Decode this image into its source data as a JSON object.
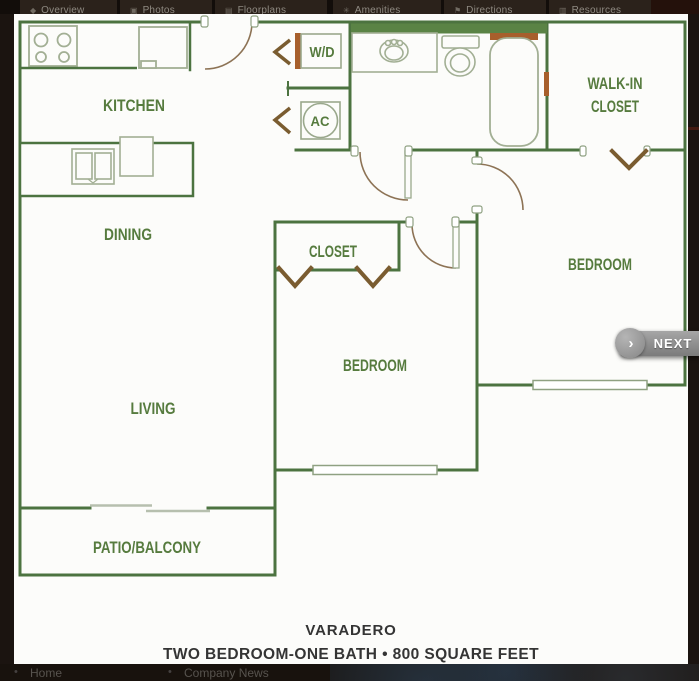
{
  "nav": {
    "items": [
      {
        "label": "Overview",
        "icon": "overview-icon",
        "glyph": "◆"
      },
      {
        "label": "Photos",
        "icon": "photos-icon",
        "glyph": "▣"
      },
      {
        "label": "Floorplans",
        "icon": "floorplans-icon",
        "glyph": "▤"
      },
      {
        "label": "Amenities",
        "icon": "amenities-icon",
        "glyph": "✳"
      },
      {
        "label": "Directions",
        "icon": "directions-icon",
        "glyph": "⚑"
      },
      {
        "label": "Resources",
        "icon": "resources-icon",
        "glyph": "▥"
      }
    ]
  },
  "floorplan": {
    "labels": {
      "kitchen": "KITCHEN",
      "dining": "DINING",
      "living": "LIVING",
      "patio": "PATIO/BALCONY",
      "closet": "CLOSET",
      "bedroom1": "BEDROOM",
      "bedroom2": "BEDROOM",
      "walk_in_1": "WALK-IN",
      "walk_in_2": "CLOSET",
      "washer_dryer": "W/D",
      "ac": "AC"
    },
    "caption": {
      "title": "VARADERO",
      "subtitle": "TWO BEDROOM-ONE BATH • 800 SQUARE FEET"
    }
  },
  "next": {
    "label": "NEXT",
    "glyph": "›"
  },
  "footer": {
    "bullet": "•",
    "items": [
      {
        "label": "Home"
      },
      {
        "label": "Company News"
      }
    ]
  },
  "colors": {
    "wall_green": "#4c7340",
    "label_green": "#567b3e",
    "thick_wall_fill": "#5a8345",
    "fixture_line": "#a2af94",
    "door_arc_brown": "#8d7355",
    "chevron_brown": "#7a5c30",
    "rust_accent": "#a75f2c",
    "nav_bg": "#2b221b",
    "caption_text": "#343434",
    "next_button_gray": "#8a8a8a"
  }
}
